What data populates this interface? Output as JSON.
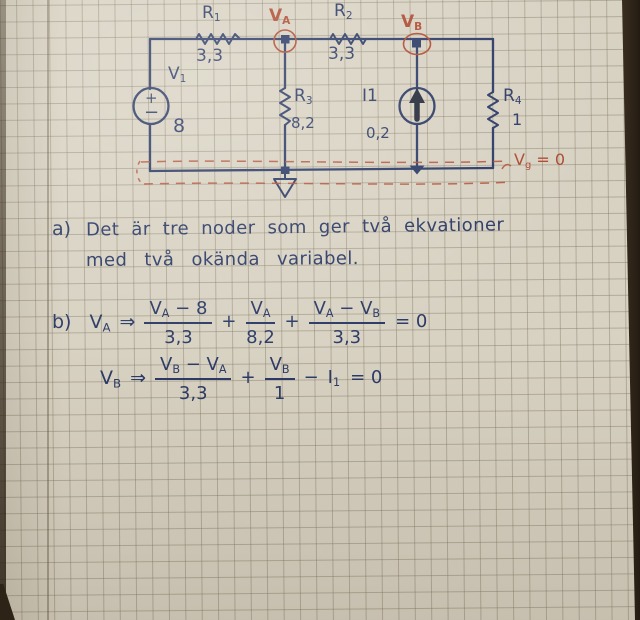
{
  "colors": {
    "paper": "#d8d2c3",
    "ink": "#2b3a66",
    "red": "#ae4a31",
    "photo_edge": "#33281c"
  },
  "circuit": {
    "r1_name": "R",
    "r1_sub": "1",
    "r1_value": "3,3",
    "r2_name": "R",
    "r2_sub": "2",
    "r2_value": "3,3",
    "r3_name": "R",
    "r3_sub": "3",
    "r3_value": "8,2",
    "r4_name": "R",
    "r4_sub": "4",
    "r4_value": "1",
    "v1_name": "V",
    "v1_sub": "1",
    "v1_value": "8",
    "v1_plus": "+",
    "v1_minus": "−",
    "i1_name": "I1",
    "i1_value": "0,2",
    "node_a_name": "V",
    "node_a_sub": "A",
    "node_b_name": "V",
    "node_b_sub": "B",
    "ground_name": "V",
    "ground_sub": "g",
    "ground_eq": " = 0"
  },
  "part_a": {
    "label": "a)",
    "line1": "Det är tre noder som ger två ekvationer",
    "line2": "med två okända variabel."
  },
  "part_b": {
    "label": "b)",
    "eq_a": {
      "node": "V",
      "node_sub": "A",
      "arrow": "⇒",
      "n1a": "V",
      "n1a_sub": "A",
      "n1b": " − 8",
      "d1": "3,3",
      "plus1": "+",
      "n2a": "V",
      "n2a_sub": "A",
      "d2": "8,2",
      "plus2": "+",
      "n3a": "V",
      "n3a_sub": "A",
      "n3b": " − ",
      "n3c": "V",
      "n3c_sub": "B",
      "d3": "3,3",
      "rhs": "= 0"
    },
    "eq_b": {
      "node": "V",
      "node_sub": "B",
      "arrow": "⇒",
      "n1a": "V",
      "n1a_sub": "B",
      "n1b": " − ",
      "n1c": "V",
      "n1c_sub": "A",
      "d1": "3,3",
      "plus1": "+",
      "n2a": "V",
      "n2a_sub": "B",
      "d2": "1",
      "minus": "−",
      "cur": "I",
      "cur_sub": "1",
      "rhs": "= 0"
    }
  }
}
